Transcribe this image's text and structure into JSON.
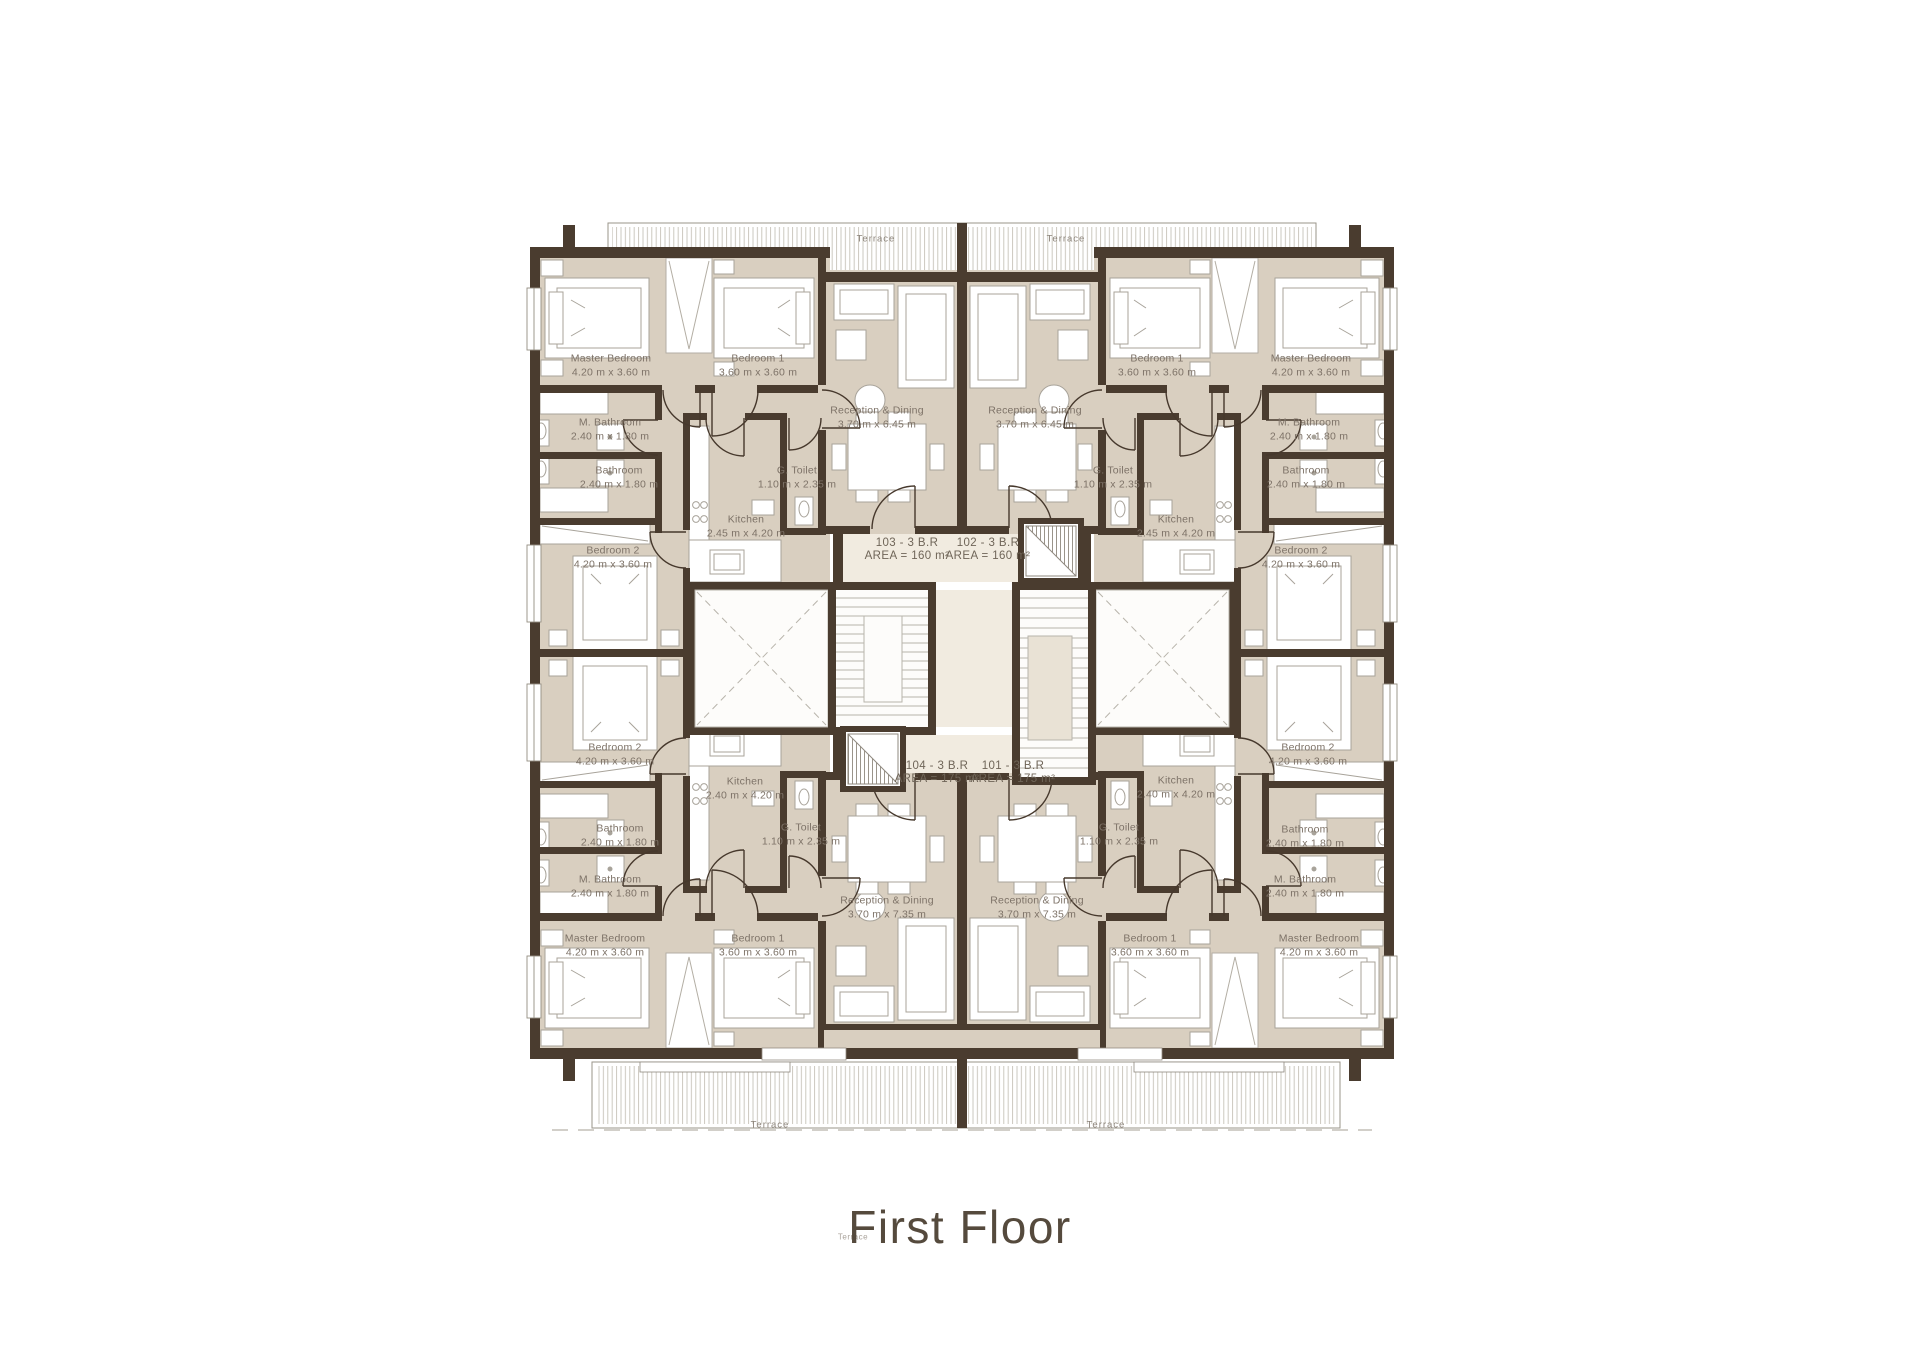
{
  "title": "First Floor",
  "terraces": {
    "top_left": "Terrace",
    "top_right": "Terrace",
    "bottom_left": "Terrace",
    "bottom_right": "Terrace",
    "stray": "Terrace"
  },
  "units": {
    "u103": {
      "tag": "103 - 3 B.R",
      "area": "AREA = 160 m²",
      "rooms": {
        "master": {
          "name": "Master Bedroom",
          "dims": "4.20 m x 3.60 m"
        },
        "bedroom1": {
          "name": "Bedroom 1",
          "dims": "3.60 m x 3.60 m"
        },
        "bedroom2": {
          "name": "Bedroom 2",
          "dims": "4.20 m x 3.60 m"
        },
        "m_bathroom": {
          "name": "M. Bathroom",
          "dims": "2.40 m x 1.80 m"
        },
        "bathroom": {
          "name": "Bathroom",
          "dims": "2.40 m x 1.80 m"
        },
        "g_toilet": {
          "name": "G. Toilet",
          "dims": "1.10 m x 2.35 m"
        },
        "kitchen": {
          "name": "Kitchen",
          "dims": "2.45 m x 4.20 m"
        },
        "reception": {
          "name": "Reception & Dining",
          "dims": "3.70 m x 6.45 m"
        }
      }
    },
    "u102": {
      "tag": "102 - 3 B.R",
      "area": "AREA = 160 m²",
      "rooms": {
        "master": {
          "name": "Master Bedroom",
          "dims": "4.20 m x 3.60 m"
        },
        "bedroom1": {
          "name": "Bedroom 1",
          "dims": "3.60 m x 3.60 m"
        },
        "bedroom2": {
          "name": "Bedroom 2",
          "dims": "4.20 m x 3.60 m"
        },
        "m_bathroom": {
          "name": "M. Bathroom",
          "dims": "2.40 m x 1.80 m"
        },
        "bathroom": {
          "name": "Bathroom",
          "dims": "2.40 m x 1.80 m"
        },
        "g_toilet": {
          "name": "G. Toilet",
          "dims": "1.10 m x 2.35 m"
        },
        "kitchen": {
          "name": "Kitchen",
          "dims": "2.45 m x 4.20 m"
        },
        "reception": {
          "name": "Reception & Dining",
          "dims": "3.70 m x 6.45 m"
        }
      }
    },
    "u104": {
      "tag": "104 - 3 B.R",
      "area": "AREA = 175 m²",
      "rooms": {
        "master": {
          "name": "Master Bedroom",
          "dims": "4.20 m x 3.60 m"
        },
        "bedroom1": {
          "name": "Bedroom 1",
          "dims": "3.60 m x 3.60 m"
        },
        "bedroom2": {
          "name": "Bedroom 2",
          "dims": "4.20 m x 3.60 m"
        },
        "m_bathroom": {
          "name": "M. Bathroom",
          "dims": "2.40 m x 1.80 m"
        },
        "bathroom": {
          "name": "Bathroom",
          "dims": "2.40 m x 1.80 m"
        },
        "g_toilet": {
          "name": "G. Toilet",
          "dims": "1.10 m x 2.35 m"
        },
        "kitchen": {
          "name": "Kitchen",
          "dims": "2.40 m x 4.20 m"
        },
        "reception": {
          "name": "Reception & Dining",
          "dims": "3.70 m x 7.35 m"
        }
      }
    },
    "u101": {
      "tag": "101 - 3 B.R",
      "area": "AREA = 175 m²",
      "rooms": {
        "master": {
          "name": "Master Bedroom",
          "dims": "4.20 m x 3.60 m"
        },
        "bedroom1": {
          "name": "Bedroom 1",
          "dims": "3.60 m x 3.60 m"
        },
        "bedroom2": {
          "name": "Bedroom 2",
          "dims": "4.20 m x 3.60 m"
        },
        "m_bathroom": {
          "name": "M. Bathroom",
          "dims": "2.40 m x 1.80 m"
        },
        "bathroom": {
          "name": "Bathroom",
          "dims": "2.40 m x 1.80 m"
        },
        "g_toilet": {
          "name": "G. Toilet",
          "dims": "1.10 m x 2.35 m"
        },
        "kitchen": {
          "name": "Kitchen",
          "dims": "2.40 m x 4.20 m"
        },
        "reception": {
          "name": "Reception & Dining",
          "dims": "3.70 m x 7.35 m"
        }
      }
    }
  }
}
